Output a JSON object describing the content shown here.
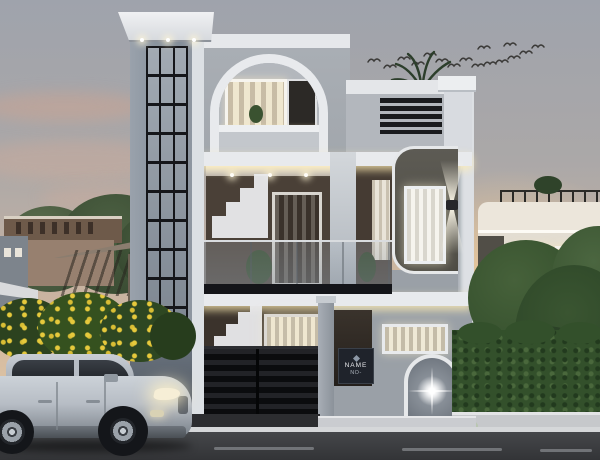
{
  "scene": {
    "type": "architectural-exterior-render",
    "time_of_day": "dusk",
    "subject": "Modern two-storey duplex elevation with arched feature tower, glass balcony railings, black slat gate and arched entry niche",
    "foreground_vehicle": "Silver SUV parked on the road facing right with headlights on",
    "background_left": "Neighbouring brown bungalow with pergola, green trees and yellow flowering shrubs",
    "background_right": "White multi-storey house behind a large tree and trimmed hedge",
    "sky": "Overcast dusk sky with warm sunset glow and a flock of birds",
    "birds_count": 16
  },
  "nameplate": {
    "title": "NAME",
    "subtitle": "NO-"
  },
  "palette": {
    "sky_top": "#9fa3ac",
    "sunset_glow": "#eccfa6",
    "facade_gray": "#a7acb2",
    "facade_white": "#e8eaed",
    "tower_gray": "#7f8a95",
    "glass_mullion": "#15161a",
    "interior_brown": "#463c33",
    "accent_panel_dark": "#56544d",
    "gate_black": "#131417",
    "warm_light": "#f0e8d2",
    "hedge_green": "#33502b",
    "flower_yellow": "#e4c437",
    "road_gray": "#3a3c3f",
    "car_silver": "#b7bdc5"
  }
}
